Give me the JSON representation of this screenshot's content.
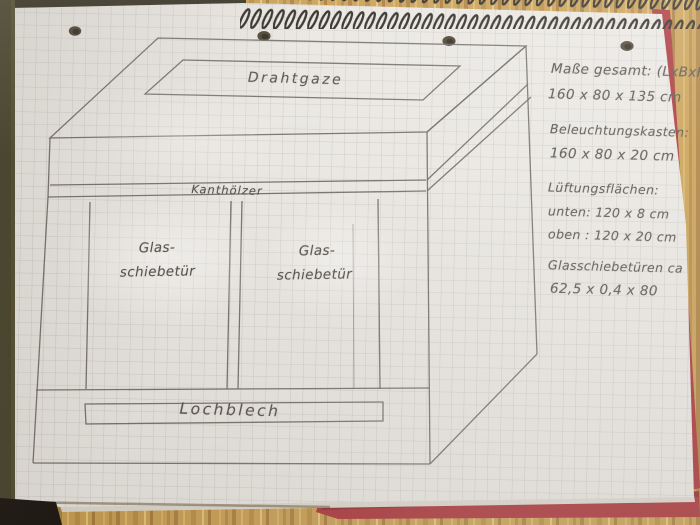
{
  "drawing_labels": {
    "top_vent": "Drahtgaze",
    "battens": "Kanthölzer",
    "left_door_line1": "Glas-",
    "left_door_line2": "schiebetür",
    "right_door_line1": "Glas-",
    "right_door_line2": "schiebetür",
    "bottom_vent": "Lochblech"
  },
  "notes": {
    "line1": "Maße gesamt: (LxBxH)",
    "line2": "160 x 80 x 135 cm",
    "line3": "Beleuchtungskasten:",
    "line4": "160 x 80 x 20 cm",
    "line5": "Lüftungsflächen:",
    "line6": "unten: 120 x 8 cm",
    "line7": "oben : 120 x 20 cm",
    "line8": "Glasschiebetüren ca",
    "line9": "62,5 x 0,4 x 80"
  },
  "colors": {
    "paper": "#eae7e2",
    "grid": "#a8a3ab",
    "pencil": "#6e6963",
    "handwriting": "#57524c",
    "wood": "#c89e52",
    "cover_red": "#a93136",
    "left_strip": "#45422a",
    "spiral": "#2b2620",
    "hole": "#4a4030"
  }
}
